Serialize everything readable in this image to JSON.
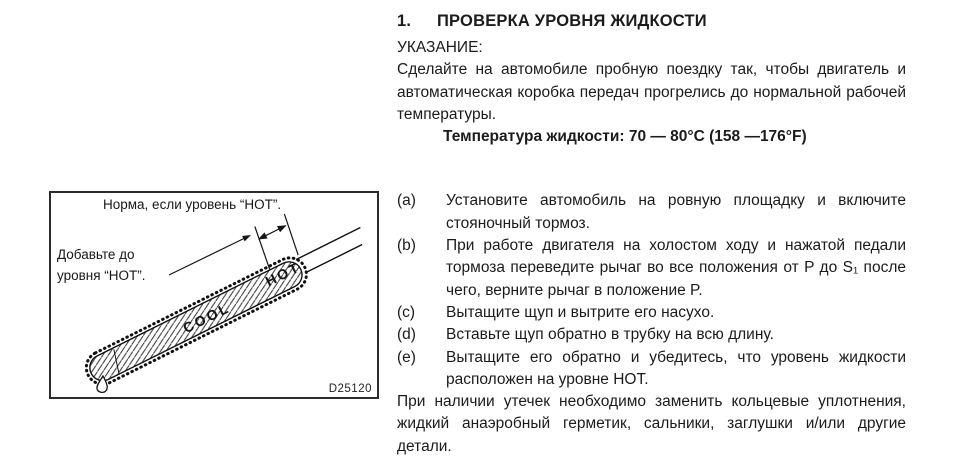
{
  "doc": {
    "heading": {
      "number": "1.",
      "title": "ПРОВЕРКА УРОВНЯ ЖИДКОСТИ"
    },
    "note_label": "УКАЗАНИЕ:",
    "note_body": "Сделайте на автомобиле пробную поездку так, чтобы двигатель и автоматическая коробка передач прогрелись до нормальной рабочей температуры.",
    "temperature_line": "Температура жидкости: 70 — 80°C (158 —176°F)",
    "steps": [
      {
        "marker": "(a)",
        "text": "Установите автомобиль на ровную площадку и включите стояночный тормоз."
      },
      {
        "marker": "(b)",
        "text": "При работе двигателя на холостом ходу и нажатой педали тормоза переведите рычаг во все положения от P до S₁ после чего, верните рычаг в положение P."
      },
      {
        "marker": "(c)",
        "text": "Вытащите щуп и вытрите его насухо."
      },
      {
        "marker": "(d)",
        "text": "Вставьте щуп обратно в трубку на всю длину."
      },
      {
        "marker": "(e)",
        "text": "Вытащите его обратно и убедитесь, что уровень жидкости расположен на уровне HOT."
      }
    ],
    "closing": "При наличии утечек необходимо заменить кольцевые уплотнения, жидкий анаэробный герметик, сальники, заглушки и/или другие детали."
  },
  "figure": {
    "caption_norm": "Норма, если уровень “HOT”.",
    "caption_add_line1": "Добавьте до",
    "caption_add_line2": "уровня “HOT”.",
    "stick_cool": "COOL",
    "stick_hot": "HOT",
    "figure_id": "D25120"
  }
}
